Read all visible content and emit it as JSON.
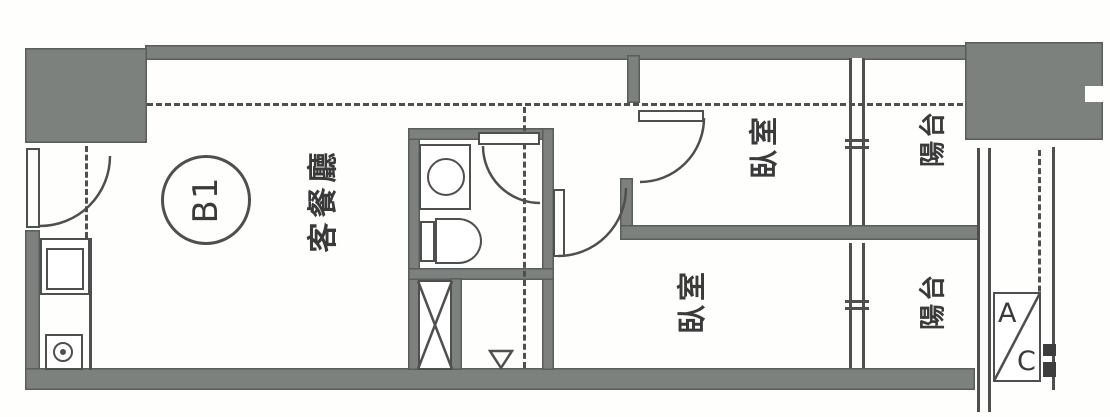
{
  "document": {
    "type": "apartment floor plan (scanned)",
    "unit_label": "B1"
  },
  "rooms": {
    "living_dining": {
      "label": "客餐廳"
    },
    "bedroom_top": {
      "label": "臥室"
    },
    "bedroom_bottom": {
      "label": "臥室"
    },
    "balcony_top": {
      "label": "陽台"
    },
    "balcony_bottom": {
      "label": "陽台"
    }
  },
  "ac_unit": {
    "top_letter": "A",
    "bottom_letter": "C"
  },
  "colors": {
    "wall": "#7c817e",
    "line": "#4f4f4f",
    "text": "#3a3a3a",
    "background": "#fefefc"
  }
}
